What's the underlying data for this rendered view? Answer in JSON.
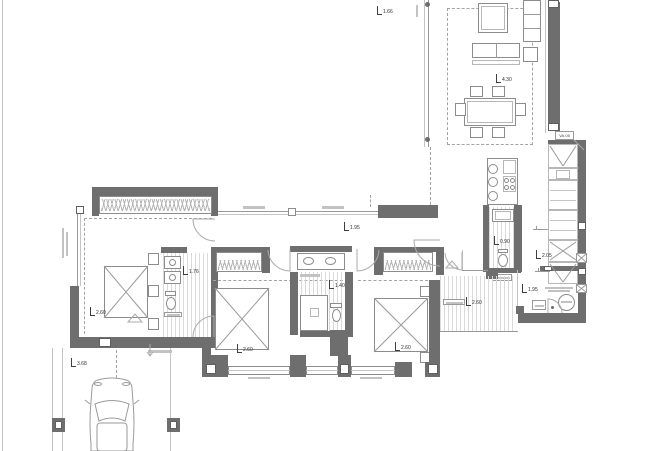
{
  "colors": {
    "wall": "#6e6e6e",
    "line": "#9a9a9a",
    "light_line": "#c4c4c4",
    "hatch": "#d9d9d9",
    "marker_text": "#2e2e2e"
  },
  "door_tag": {
    "label": "VA.05",
    "x": 555,
    "y": 131
  },
  "level_markers": [
    {
      "value": "1.66",
      "x": 377,
      "y": 6
    },
    {
      "value": "4.30",
      "x": 496,
      "y": 74
    },
    {
      "value": "1.95",
      "x": 344,
      "y": 222
    },
    {
      "value": "0.90",
      "x": 494,
      "y": 236
    },
    {
      "value": "2.05",
      "x": 536,
      "y": 250
    },
    {
      "value": "1.95",
      "x": 522,
      "y": 284
    },
    {
      "value": "2.60",
      "x": 466,
      "y": 297
    },
    {
      "value": "2.60",
      "x": 90,
      "y": 307
    },
    {
      "value": "1.76",
      "x": 183,
      "y": 266
    },
    {
      "value": "2.60",
      "x": 237,
      "y": 344
    },
    {
      "value": "1.40",
      "x": 329,
      "y": 280
    },
    {
      "value": "2.60",
      "x": 395,
      "y": 342
    },
    {
      "value": "3.68",
      "x": 71,
      "y": 358
    }
  ]
}
